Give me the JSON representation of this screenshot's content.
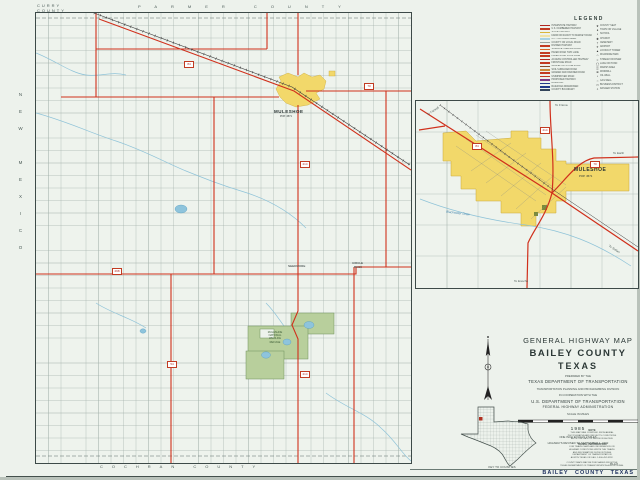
{
  "sheet": {
    "footer_label": "BAILEY COUNTY TEXAS",
    "sheet_ref": "85-127"
  },
  "edges": {
    "corner_top_left_1": "CURRY",
    "corner_top_left_2": "COUNTY",
    "top": "PARMER COUNTY",
    "left": "NEW MEXICO",
    "right": "LAMB COUNTY",
    "bottom": "COCHRAN COUNTY"
  },
  "main_map": {
    "city_label": "MULESHOE",
    "city_pop": "POP. 4571",
    "needmore": "NEEDMORE",
    "circle_back_1": "CIRCLE",
    "circle_back_2": "BACK",
    "refuge_lines": [
      "MULESHOE",
      "NATIONAL",
      "WILDLIFE",
      "REFUGE"
    ],
    "shields": {
      "us84": "84",
      "us70": "70",
      "tx214": "214",
      "tx214b": "214",
      "fm298": "298",
      "fm54": "54"
    }
  },
  "inset": {
    "city_label": "MULESHOE",
    "city_pop": "POP. 4571",
    "stream_label": "Blackwater Draw",
    "to_farwell": "To Farwell",
    "to_friona": "To Friona",
    "to_earth": "To Earth",
    "to_sudan": "To Sudan",
    "to_enochs": "To Enochs",
    "shield_us84": "84",
    "shield_tx214": "214",
    "shield_us70": "70"
  },
  "legend": {
    "title": "LEGEND",
    "left": [
      {
        "color": "#b02820",
        "label": "INTERSTATE HIGHWAY"
      },
      {
        "color": "#c23b22",
        "label": "U.S. NUMBERED HIGHWAY"
      },
      {
        "color": "#d9b63c",
        "label": "STATE HIGHWAY"
      },
      {
        "color": "#efe3a8",
        "label": "FARM OR RANCH TO MARKET ROAD"
      },
      {
        "color": "#a6d2e3",
        "label": "CITY OR URBAN AREA"
      },
      {
        "color": "#9aa49e",
        "label": "COUNTY OR LOCAL ROAD"
      },
      {
        "color": "#c23b22",
        "label": "DIVIDED HIGHWAY"
      },
      {
        "color": "#d96428",
        "label": "SURFACE TREATED ROAD"
      },
      {
        "color": "#c23b22",
        "label": "PAVED ROAD TWO LANE"
      },
      {
        "color": "#c23b22",
        "label": "PAVED ROAD FOUR LANE"
      },
      {
        "color": "#b02820",
        "label": "ACCESS CONTROLLED HIGHWAY"
      },
      {
        "color": "#c23b22",
        "label": "FRONTAGE ROAD"
      },
      {
        "color": "#8a4a2a",
        "label": "GRAVEL OR STONE ROAD"
      },
      {
        "color": "#c98a3c",
        "label": "SOIL SURFACED ROAD"
      },
      {
        "color": "#c23b22",
        "label": "GRADED AND DRAINED ROAD"
      },
      {
        "color": "#c23b22",
        "label": "UNIMPROVED ROAD"
      },
      {
        "color": "#7a3a86",
        "label": "PROPOSED HIGHWAY"
      },
      {
        "color": "#223a8a",
        "label": "RAILROAD"
      },
      {
        "color": "#223a8a",
        "label": "RAILROAD ABANDONED"
      },
      {
        "color": "#33445a",
        "label": "COUNTY BOUNDARY"
      }
    ],
    "right": [
      {
        "glyph": "★",
        "label": "COUNTY SEAT"
      },
      {
        "glyph": "●",
        "label": "TOWN OR VILLAGE"
      },
      {
        "glyph": "▪",
        "label": "SCHOOL"
      },
      {
        "glyph": "✚",
        "label": "CHURCH"
      },
      {
        "glyph": "†",
        "label": "CEMETERY"
      },
      {
        "glyph": "✈",
        "label": "AIRPORT"
      },
      {
        "glyph": "▲",
        "label": "LOOKOUT TOWER"
      },
      {
        "glyph": "⌂",
        "label": "ROADSIDE PARK"
      },
      {
        "glyph": "≈",
        "label": "STREAM OR RIVER"
      },
      {
        "glyph": "◯",
        "label": "LAKE OR POND"
      },
      {
        "glyph": "▒",
        "label": "MARSH AREA"
      },
      {
        "glyph": "⊕",
        "label": "WINDMILL"
      },
      {
        "glyph": "•",
        "label": "OIL WELL"
      },
      {
        "glyph": "○",
        "label": "GAS WELL"
      },
      {
        "glyph": "▭",
        "label": "BUSINESS DISTRICT"
      },
      {
        "glyph": "⌖",
        "label": "RANGER STATION"
      }
    ]
  },
  "title_block": {
    "line1": "GENERAL HIGHWAY MAP",
    "county": "BAILEY COUNTY",
    "state": "TEXAS",
    "prepared": "PREPARED BY THE",
    "dept": "TEXAS DEPARTMENT OF TRANSPORTATION",
    "division": "TRANSPORTATION PLANNING AND PROGRAMMING DIVISION",
    "coop": "IN COOPERATION WITH THE",
    "usdot": "U.S. DEPARTMENT OF TRANSPORTATION",
    "fhwa": "FEDERAL HIGHWAY ADMINISTRATION",
    "scale_caption": "SCALE IN MILES",
    "year": "1985",
    "scale_note": "ONE INCH EQUALS 2 MILES",
    "revised": "HIGHWAYS REVISED TO SEPTEMBER 1, 1992"
  },
  "key_map": {
    "caption": "KEY TO COUNTIES"
  },
  "notes": {
    "note_title": "NOTE",
    "note_lines": [
      "THIS MAP WAS COMPILED FROM AERIAL",
      "PHOTOGRAPHS AND REFLECTS CONDITIONS",
      "AS OF THE DATE OF REVISION SHOWN."
    ],
    "travel_title": "TRAVEL INFORMATION",
    "travel_lines": [
      "FOR TRAVEL MAPS AND INFORMATION ON",
      "HIGHWAY CONDITIONS WRITE THE TRAVEL",
      "AND INFORMATION DIVISION TEXAS",
      "DEPARTMENT OF TRANSPORTATION",
      "AUSTIN TEXAS OR CALL 1-800-452-9292."
    ],
    "purchase_lines": [
      "COUNTY MAPS MAY BE PURCHASED FROM THE",
      "TEXAS DEPARTMENT OF TRANSPORTATION AUSTIN TEXAS."
    ]
  }
}
